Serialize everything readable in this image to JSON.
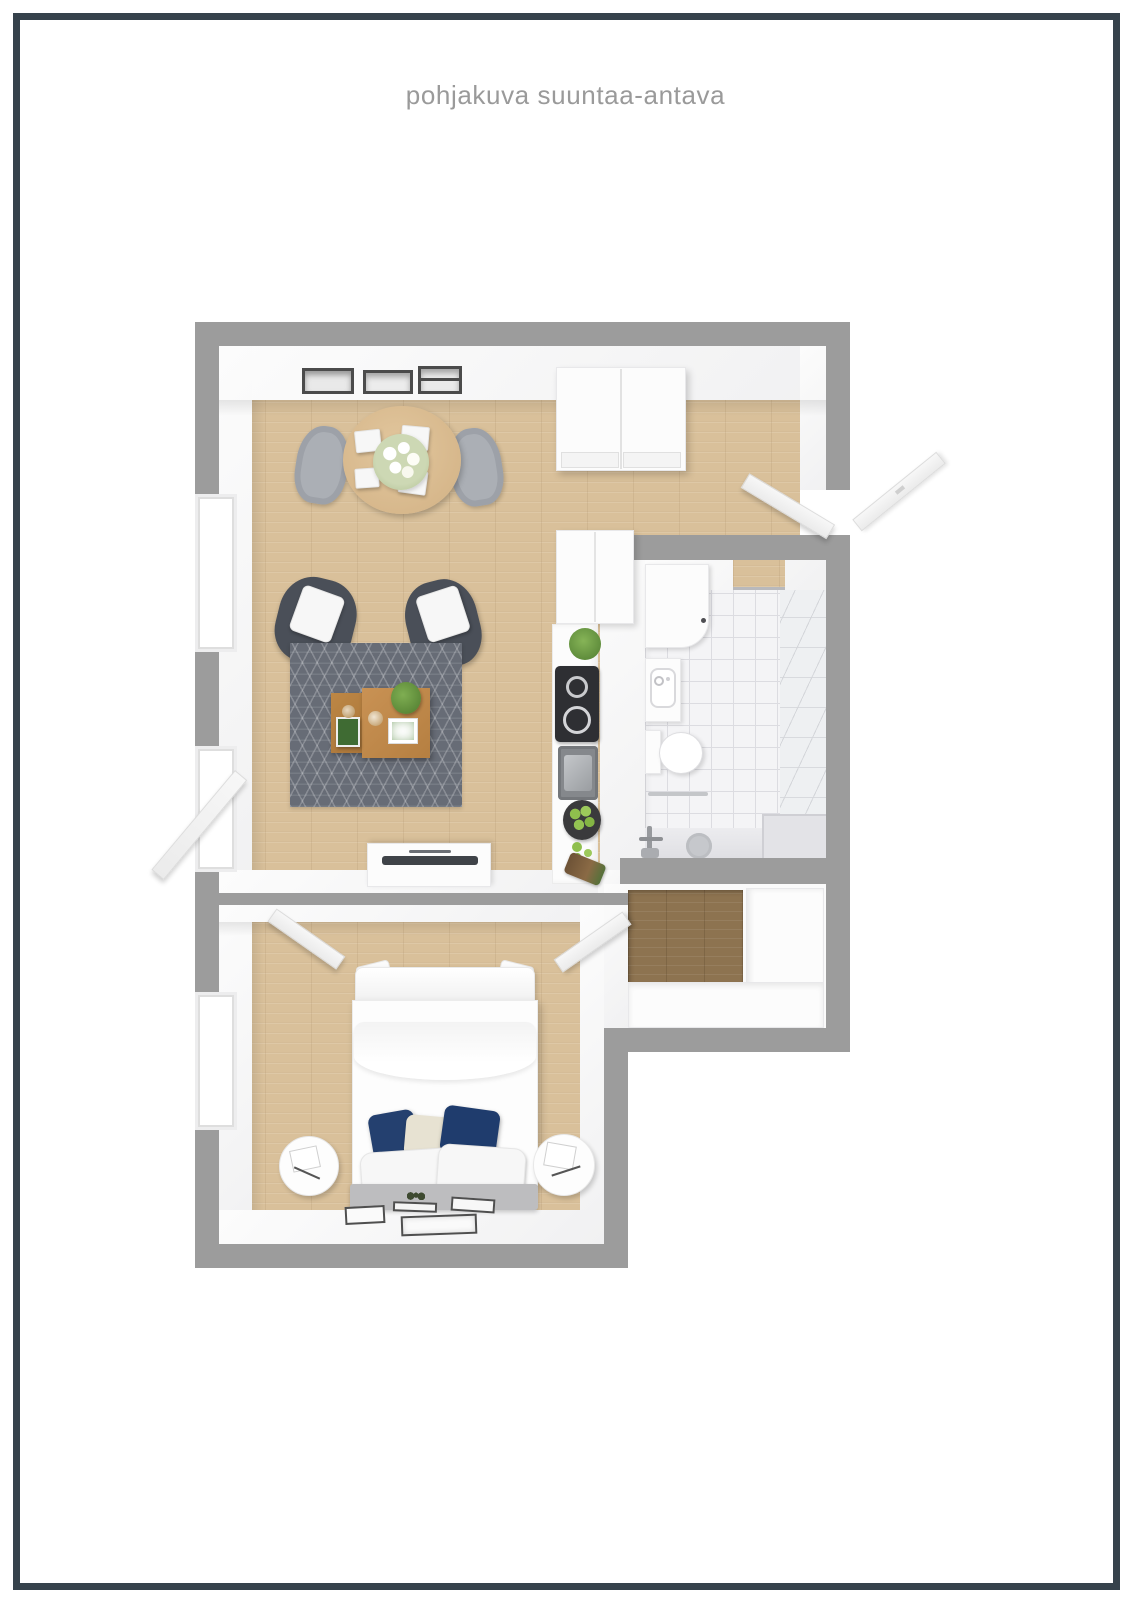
{
  "page": {
    "title": "pohjakuva suuntaa-antava",
    "frame_color": "#36424c",
    "background": "#ffffff",
    "title_color": "#9a9a9a"
  },
  "palette": {
    "wall_gray": "#9c9c9c",
    "wall_face_white": "#f7f7f7",
    "wood_light": "#d9c09a",
    "wood_dark_hall": "#8d7350",
    "bathroom_tile": "#f4f4f6",
    "rug_gray": "#676c76",
    "armchair_gray": "#4a4f58",
    "pillow_navy": "#21406f",
    "pillow_cream": "#e7e2d2",
    "coffee_table_wood": "#c08b4f",
    "cooktop_black": "#2e2f33",
    "apples_green": "#8fbf4d"
  },
  "floorplan": {
    "type": "3d-top-down-apartment-render",
    "rooms": [
      {
        "name": "living-room",
        "floor": "light-wood",
        "items": [
          "wall-frames",
          "dining-table",
          "dining-chairs",
          "flower-bouquet",
          "wardrobe",
          "armchair-left",
          "armchair-right",
          "patterned-rug",
          "coffee-table-large",
          "coffee-table-small",
          "tv-bench",
          "open-balcony-door",
          "window"
        ]
      },
      {
        "name": "kitchen",
        "floor": "light-wood",
        "items": [
          "tall-cabinet",
          "counter",
          "herb-plant",
          "cooktop-two-burners",
          "sink",
          "fruit-bowl",
          "apples",
          "cutting-log"
        ]
      },
      {
        "name": "bathroom",
        "floor": "white-tile",
        "items": [
          "washing-machine",
          "washbasin",
          "toilet",
          "towel-rail",
          "shower-mixer",
          "floor-drain",
          "step-bench",
          "doorway"
        ]
      },
      {
        "name": "entry",
        "floor": "light-wood",
        "items": [
          "front-door-open-outside",
          "inner-door-open-inside"
        ]
      },
      {
        "name": "hall",
        "floor": "dark-wood",
        "items": [
          "closet-vertical",
          "closet-horizontal"
        ]
      },
      {
        "name": "bedroom",
        "floor": "light-wood",
        "items": [
          "double-bed",
          "navy-pillows",
          "white-pillows",
          "foot-blanket",
          "nightstand-left",
          "nightstand-right",
          "wall-lamp-left",
          "wall-lamp-right",
          "floor-art-frames",
          "window"
        ]
      }
    ]
  }
}
